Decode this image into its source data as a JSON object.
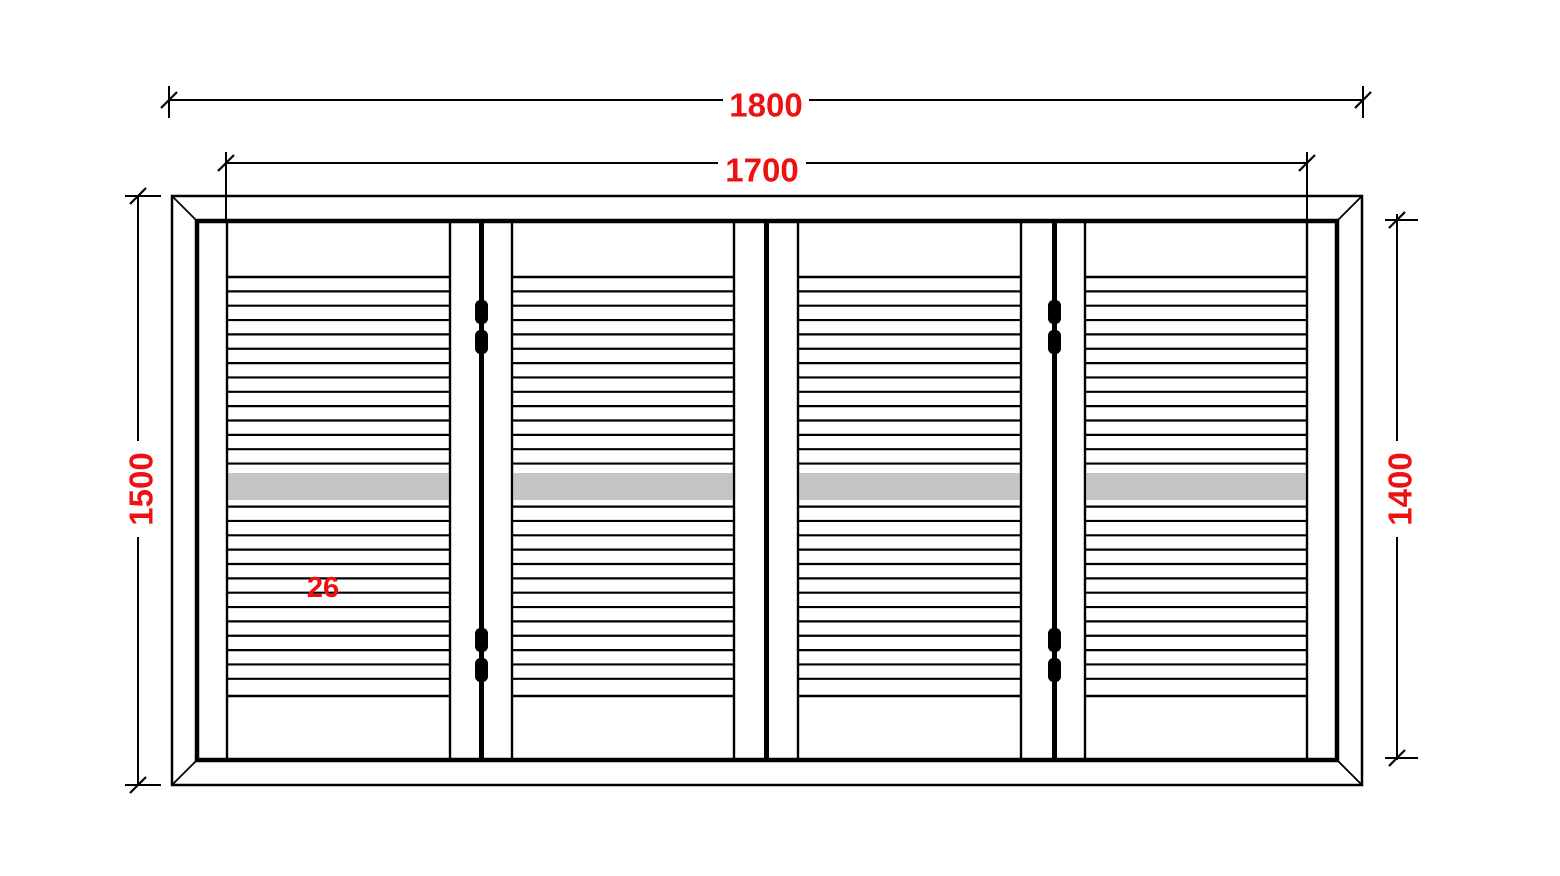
{
  "drawing_title": "Louvered bifold shutter elevation drawing",
  "colors": {
    "line": "#000000",
    "dimension_text": "#ee1111",
    "mid_band": "#c5c5c5",
    "background": "#ffffff"
  },
  "dimensions": {
    "outer_width": {
      "label": "1800"
    },
    "inner_width": {
      "label": "1700"
    },
    "outer_height": {
      "label": "1500"
    },
    "inner_height": {
      "label": "1400"
    },
    "louver_note": {
      "label": "26"
    }
  },
  "shutter": {
    "panel_count": 4,
    "louver_lines_per_panel": 26,
    "hinged_joints": 2,
    "hinges_per_hinged_joint": 2,
    "plain_meeting_joints": 1,
    "mid_band_present": true
  }
}
